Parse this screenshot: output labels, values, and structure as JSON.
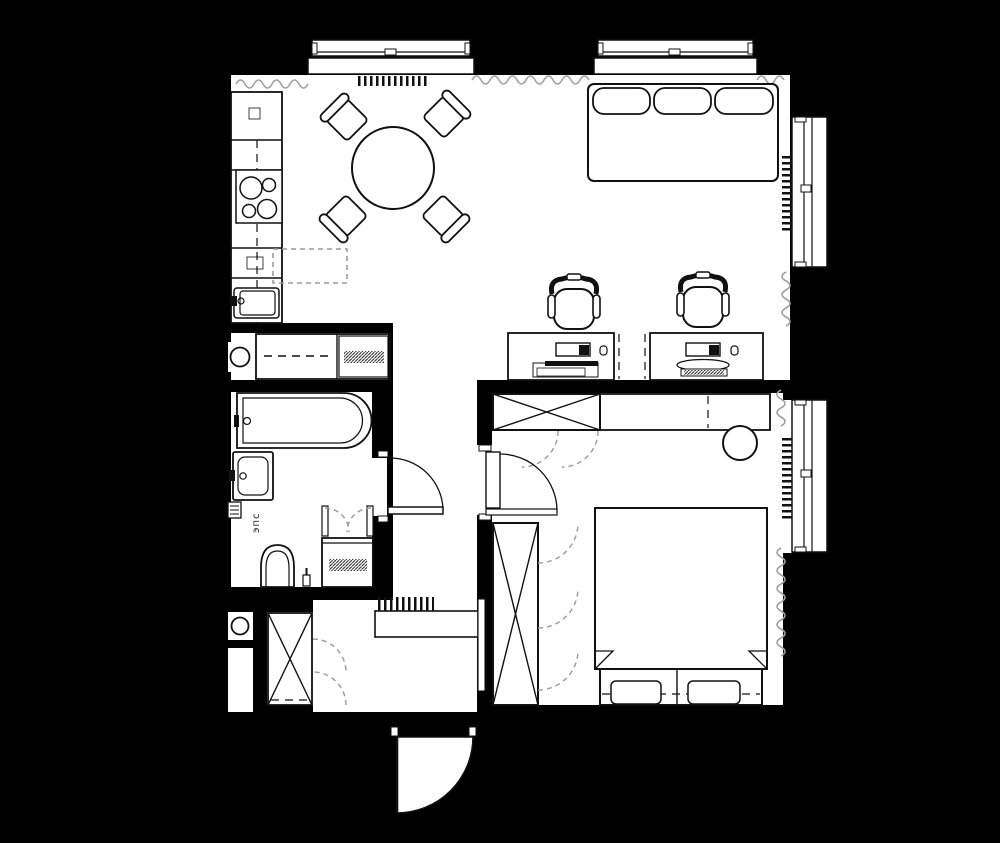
{
  "colors": {
    "bg": "#000000",
    "floor": "#ffffff",
    "line": "#111111",
    "dash": "#9b9b9b",
    "curtain": "#a0a0a0"
  },
  "labels": {
    "electrical_panel": "эпс"
  },
  "plan": {
    "type": "apartment-floor-plan",
    "rooms": [
      {
        "name": "living-kitchen-dining",
        "furniture": [
          "kitchen counter",
          "refrigerator",
          "cooktop 4-burner",
          "kitchen sink",
          "round dining table",
          "4 dining chairs",
          "3-seat sofa",
          "2 desks",
          "2 office chairs",
          "2 monitors with keyboards"
        ]
      },
      {
        "name": "laundry-niche",
        "furniture": [
          "counter",
          "washing machine",
          "utility shaft"
        ]
      },
      {
        "name": "bathroom",
        "furniture": [
          "bathtub",
          "washbasin",
          "toilet",
          "electrical panel",
          "appliance cabinet with bifold doors"
        ]
      },
      {
        "name": "hallway",
        "furniture": [
          "coat hooks",
          "shoe bench",
          "wall mirror"
        ]
      },
      {
        "name": "entry-closet",
        "furniture": [
          "wardrobe with X symbol",
          "bifold doors",
          "utility shaft"
        ]
      },
      {
        "name": "bedroom",
        "furniture": [
          "double bed with pillows",
          "wardrobe with X symbol",
          "tall wardrobe with folding doors",
          "vanity console",
          "stool"
        ]
      }
    ],
    "openings": {
      "top_windows": 2,
      "right_windows": 2,
      "radiators": 4,
      "interior_doors": 2,
      "entry_door": 1,
      "curtains": 6
    }
  }
}
